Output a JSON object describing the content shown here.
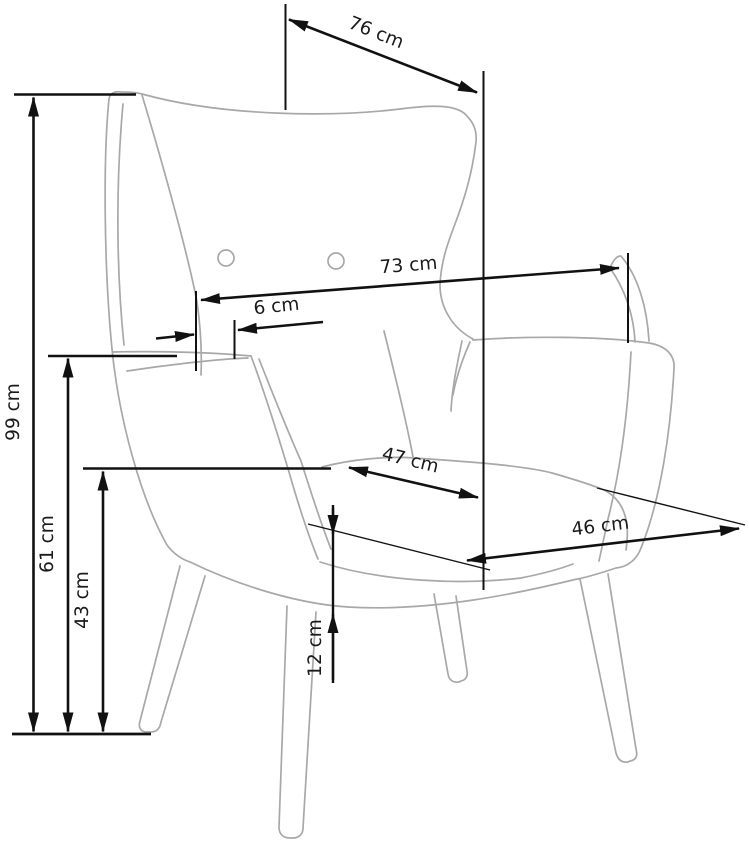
{
  "figure": {
    "type": "furniture dimension diagram",
    "subject": "Wingback armchair technical line drawing with dimension arrows",
    "unit": "cm",
    "background_color": "#ffffff",
    "dimension_line_color": "#111111",
    "chair_outline_color": "#a8a8a8"
  },
  "dimensions": [
    {
      "id": "dim-76",
      "label": "76 cm",
      "value": 76,
      "placement": "top diagonal depth arrow"
    },
    {
      "id": "dim-73",
      "label": "73 cm",
      "value": 73,
      "placement": "upper width arrow across backrest"
    },
    {
      "id": "dim-6",
      "label": "6 cm",
      "value": 6,
      "placement": "small thickness at left side"
    },
    {
      "id": "dim-47",
      "label": "47 cm",
      "value": 47,
      "placement": "seat diagonal arrow"
    },
    {
      "id": "dim-46",
      "label": "46 cm",
      "value": 46,
      "placement": "seat front width arrow"
    },
    {
      "id": "dim-12",
      "label": "12 cm",
      "value": 12,
      "placement": "seat frame thickness, vertical"
    },
    {
      "id": "dim-99",
      "label": "99 cm",
      "value": 99,
      "placement": "overall height, left vertical"
    },
    {
      "id": "dim-61",
      "label": "61 cm",
      "value": 61,
      "placement": "armrest height, left vertical"
    },
    {
      "id": "dim-43",
      "label": "43 cm",
      "value": 43,
      "placement": "seat height, left vertical"
    }
  ]
}
